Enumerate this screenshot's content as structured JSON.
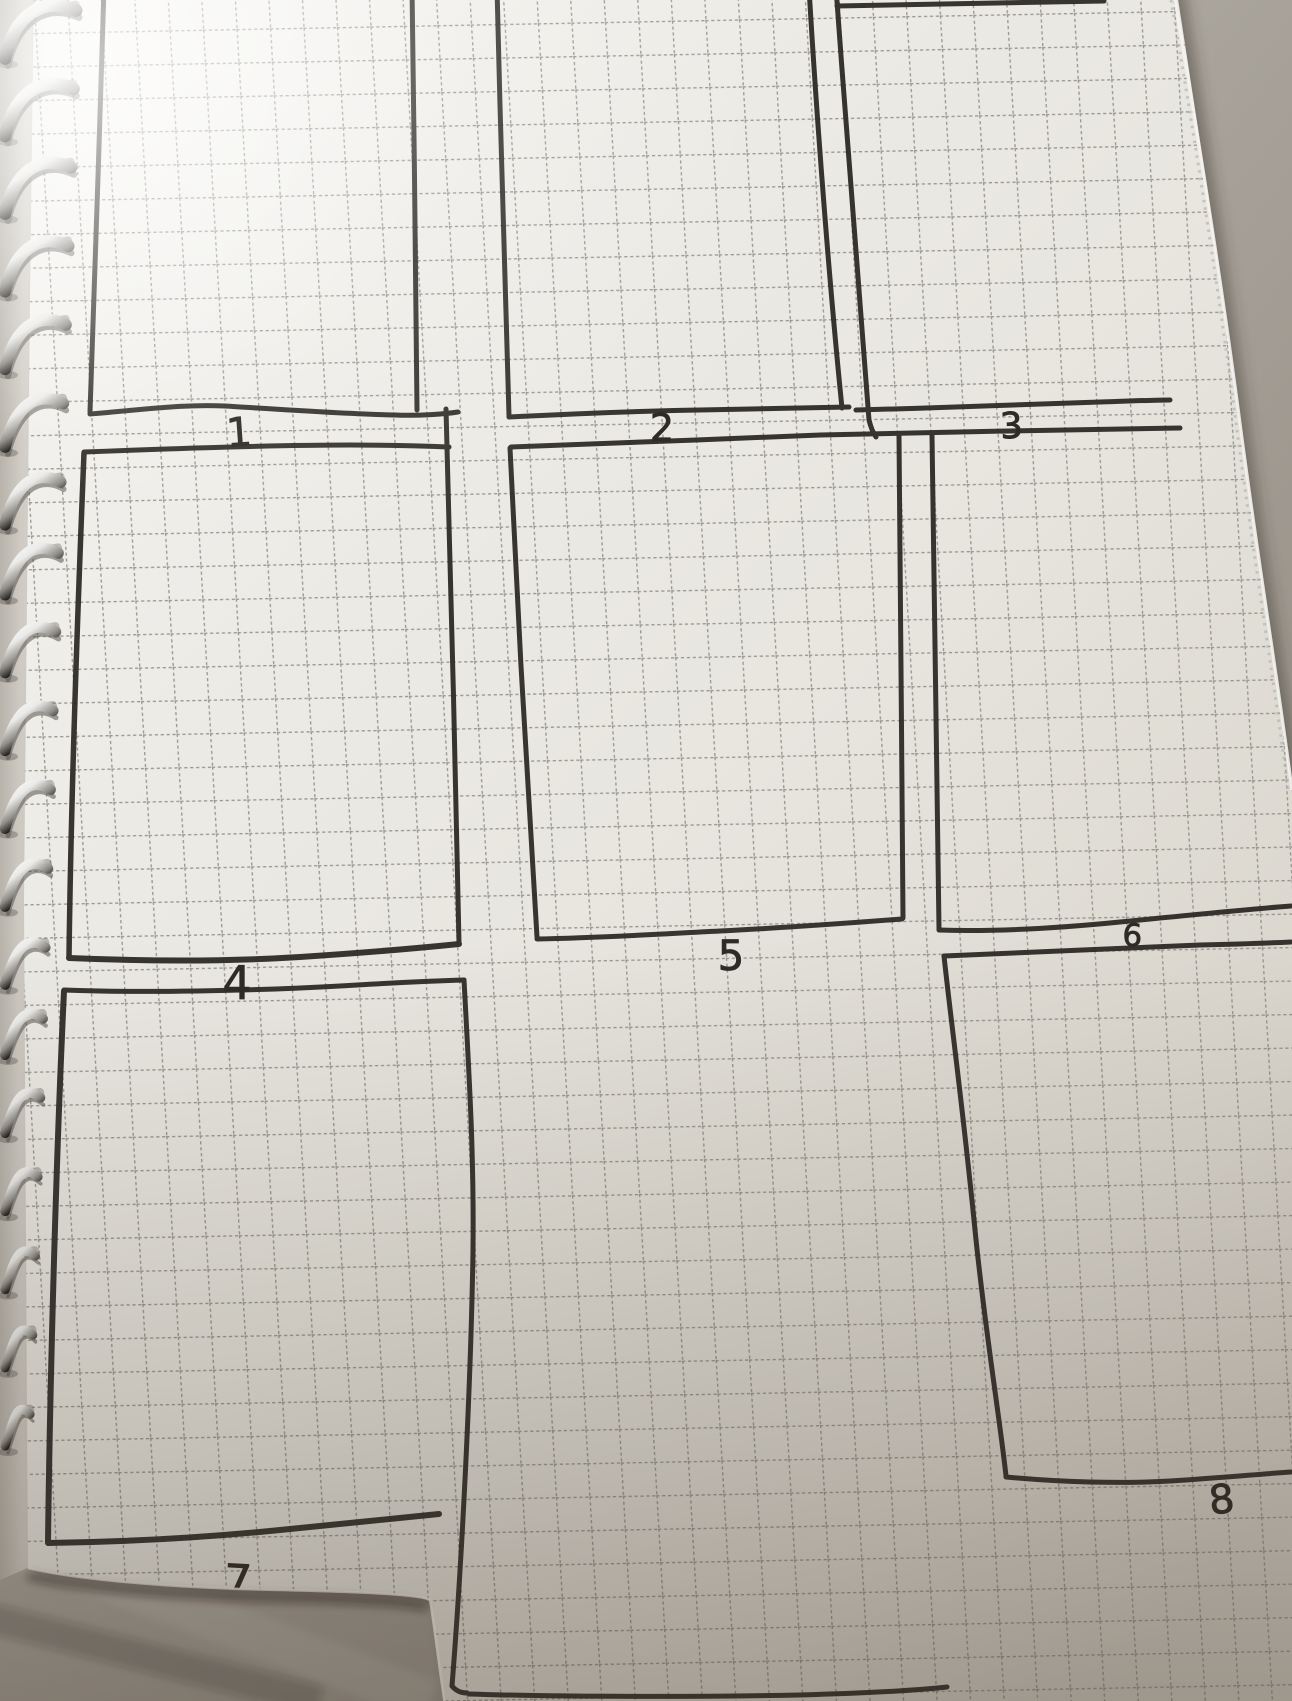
{
  "scene": {
    "description": "Photograph of a spiral-bound notebook lying on a fabric surface. The squared (dashed grid) page has a hand-drawn 3x3 storyboard panel layout in black marker, panels numbered 1 to 8.",
    "panel_count": 9,
    "numbered_panels_visible": 8
  },
  "panels": [
    {
      "label": "1",
      "row": 1,
      "col": 1
    },
    {
      "label": "2",
      "row": 1,
      "col": 2
    },
    {
      "label": "3",
      "row": 1,
      "col": 3
    },
    {
      "label": "4",
      "row": 2,
      "col": 1
    },
    {
      "label": "5",
      "row": 2,
      "col": 2
    },
    {
      "label": "6",
      "row": 2,
      "col": 3
    },
    {
      "label": "7",
      "row": 3,
      "col": 1
    },
    {
      "label": "8",
      "row": 3,
      "col": 3
    }
  ],
  "notebook": {
    "binding": "metal wire spiral, left edge",
    "spiral_coil_count": 19,
    "paper": "off-white squared paper with dashed grid lines"
  },
  "colors": {
    "ink": "#2e2b27",
    "paper": "#e9e7e1",
    "grid_line": "#86837d",
    "fabric": "#a39d94",
    "spiral_metal": "#c9c9c7"
  }
}
